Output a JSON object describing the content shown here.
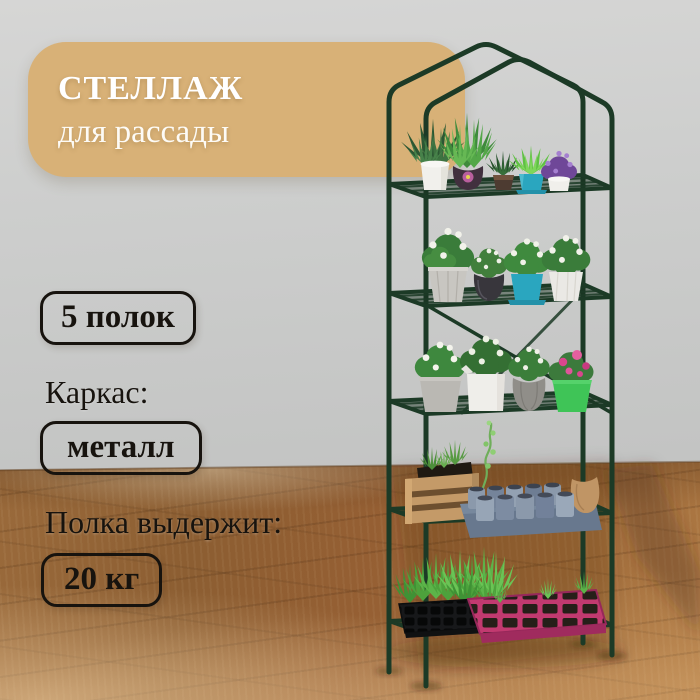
{
  "badge": {
    "title": "СТЕЛЛАЖ",
    "subtitle": "для рассады"
  },
  "specs": {
    "shelves": "5 полок",
    "frame_label": "Каркас:",
    "frame_value": "металл",
    "capacity_label": "Полка выдержит:",
    "capacity_value": "20 кг"
  },
  "palette": {
    "badge_bg": "#d8b177",
    "badge_text": "#ffffff",
    "wall_gray": "#cbccca",
    "floor_wood_mid": "#9a6a3b",
    "floor_wood_light": "#c49a68",
    "floor_shadow": "#4a2c16",
    "rack_green": "#1c3a26",
    "spec_text": "#17130e",
    "spec_border": "#17130e"
  },
  "illustration": {
    "shelf_count": 5,
    "background": [
      "gray-wall",
      "wood-plank-floor"
    ],
    "rack_color_name": "dark-green-metal",
    "shelves": [
      {
        "items": [
          "white-pot-grass-plant",
          "plum-round-pot-tall-grass",
          "small-bronze-pot-succulent",
          "teal-pot-grass",
          "white-pot-purple-flowers"
        ]
      },
      {
        "items": [
          "gray-faceted-pot-white-flowers",
          "black-round-pot-plant",
          "teal-pot-saucer-white-flowers",
          "white-pot-white-flowers"
        ]
      },
      {
        "items": [
          "gray-pot-white-flowers",
          "white-square-pitcher-plant",
          "gray-ribbed-vase-white-flowers",
          "green-pot-pink-flowers"
        ]
      },
      {
        "items": [
          "wooden-crate-with-soil",
          "climbing-seedling-vine",
          "denim-fabric-seedling-pots",
          "burlap-sack"
        ]
      },
      {
        "items": [
          "black-seedling-tray-green-sprouts",
          "magenta-seedling-tray-soil-cells"
        ]
      }
    ]
  }
}
